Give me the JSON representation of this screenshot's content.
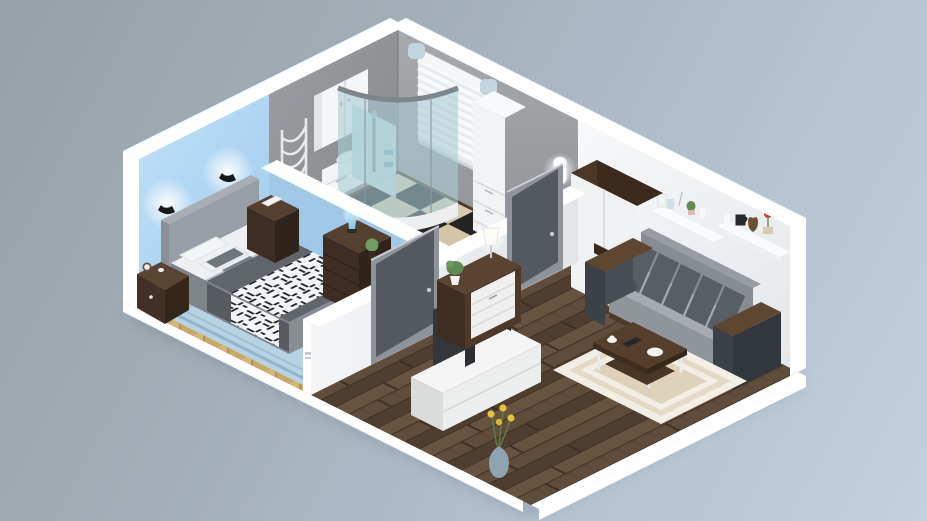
{
  "meta": {
    "title": "3D isometric cutaway floor plan render of a one-bedroom apartment",
    "view": "isometric 3/4 top-down render",
    "background_top_left": "#97a1a7",
    "background_bottom_right": "#c2d0e0"
  },
  "palette": {
    "cut_wall_white": "#ffffff",
    "bedroom_wall_blue": "#aed5f2",
    "divider_blue": "#a0c8e7",
    "bathroom_wall_gray": "#8f9296",
    "right_wall_gray": "#9b9ea2",
    "right_wall_white": "#eef0f2",
    "interior_wall_white": "#edeff1",
    "bedroom_floor_oak": "#c9a765",
    "bathroom_tile_black": "#242423",
    "bathroom_tile_beige": "#d9cbae",
    "tile_border_wood": "#513d29",
    "living_floor_brown": "#5a4737",
    "rug_bedroom_blue": "#b7d2e2",
    "rug_bedroom_border": "#8fb4c9",
    "rug_living_cream": "#f3efe6",
    "rug_living_band": "#e3d9c5",
    "rug_living_center": "#ded2ba",
    "bed_frame_gray": "#7e848a",
    "bed_headboard_gray": "#989ea5",
    "duvet_gray": "#60656b",
    "pillow_white": "#f4f5f7",
    "pillow_accent_gray": "#70767d",
    "throw_pattern_black": "#202225",
    "furniture_walnut_dark": "#3e2d22",
    "furniture_walnut_mid": "#55402f",
    "sofa_body_gray": "#9aa0a5",
    "sofa_cushion_dark": "#585e64",
    "sofa_arm_dark": "#3c4148",
    "door_gray": "#54595f",
    "door_frame_gray": "#8d9399",
    "wardrobe_white": "#eff1f2",
    "shower_glass_teal": "#a9cdd6",
    "blinds_white": "#f2f4f5",
    "blinds_cap_blue": "#c2d5df",
    "tv_dark": "#33373c",
    "tv_stand_white": "#eceeed",
    "lamp_glow_white": "#ffffff",
    "lava_lamp_blue": "#8ed0f0",
    "plant_green": "#5e8a54",
    "flower_yellow": "#e4c43c",
    "flower_red": "#d0452f",
    "vase_blue_gray": "#8fa3b0"
  },
  "scene": {
    "rooms": [
      {
        "name": "bedroom",
        "items": [
          "double bed with gray duvet and black-white patterned throw",
          "white pillows and gray accent pillows",
          "upholstered headboard",
          "two glowing wall lamps",
          "left nightstand with alarm clock and cup",
          "right nightstand with book",
          "chest of drawers with lava lamp and ball plant",
          "light blue bordered rug",
          "oak parquet floor"
        ]
      },
      {
        "name": "bathroom",
        "items": [
          "corner shower cabin with teal glass",
          "window with white blinds",
          "sink vanity with two drawers",
          "white wall cabinet",
          "tall storage cabinet",
          "chrome towel radiator",
          "toilet",
          "black and beige checkerboard tile floor",
          "wall sconce"
        ]
      },
      {
        "name": "living-room",
        "items": [
          "two-door wardrobe with walnut side",
          "two white wall shelves with decor (boxes, candles, mug, vases, cactus, red flower)",
          "gray sofa with five dark cushions and walnut armrest tops",
          "walnut coffee table with cup, plate and tablet",
          "cream layered rug",
          "flat TV on light media stand",
          "vase with yellow flowers",
          "hall dresser with table lamp and potted plant",
          "dark wood plank floor"
        ]
      }
    ],
    "doors": [
      "bedroom door (dark gray)",
      "bathroom door (dark gray)"
    ]
  }
}
